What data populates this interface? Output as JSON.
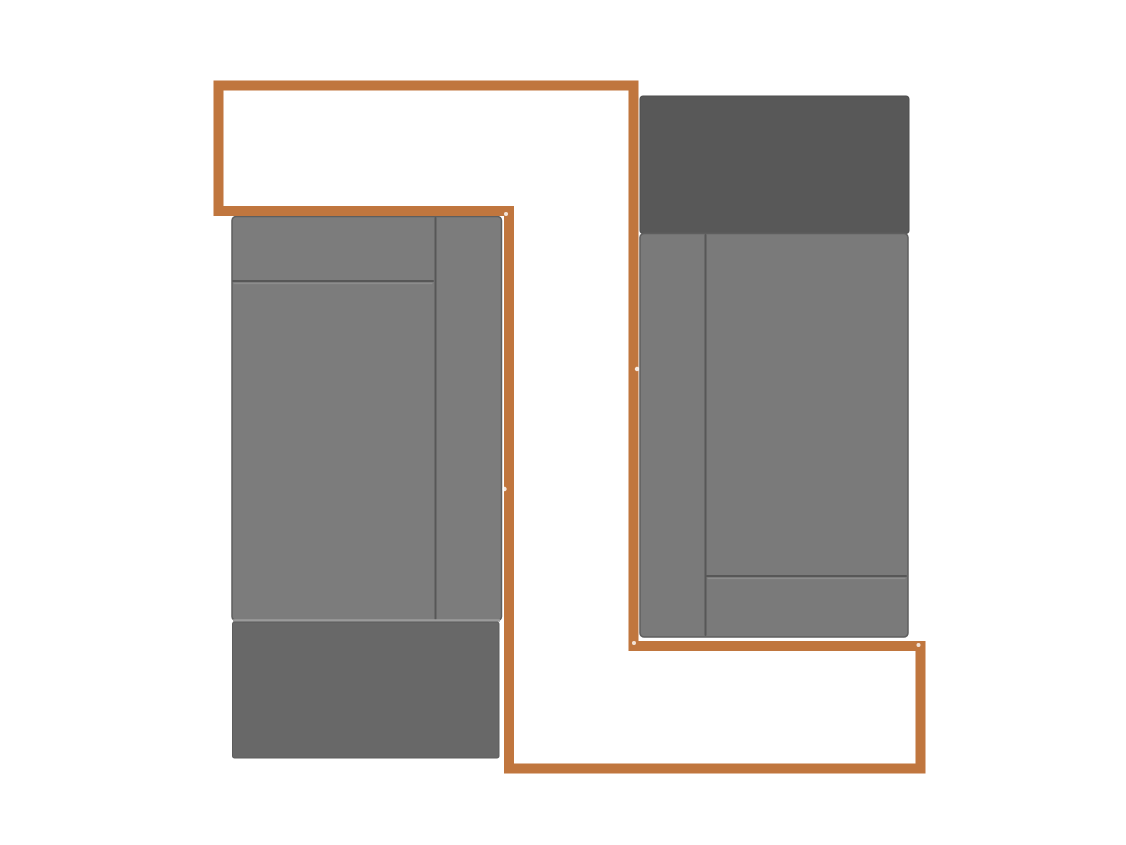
{
  "app": {
    "view_label": "cabinet-layout-design-view"
  },
  "canvas": {
    "width": 1126,
    "height": 845,
    "background": "#ffffff"
  },
  "palette": {
    "outline_orange": "#c0763e",
    "left_cabinet_body": "#7c7c7c",
    "left_cabinet_base": "#686868",
    "right_cabinet_top": "#585858",
    "right_cabinet_body": "#7a7a7a",
    "panel_line": "#575757",
    "panel_highlight": "#9b9b9b",
    "edge_stroke": "#5e5e5e",
    "marker_white": "#ffffff"
  },
  "shapes": [
    {
      "name": "left-cabinet-body",
      "interactable": true,
      "type": "rect",
      "x": 232,
      "y": 216.5,
      "w": 269.5,
      "h": 404,
      "fill": "#7c7c7c",
      "stroke": "#5e5e5e",
      "stroke_width": 1.5,
      "rx": 4
    },
    {
      "name": "left-cabinet-drawer-divider-line",
      "interactable": false,
      "type": "line",
      "x1": 233,
      "y1": 281,
      "x2": 433,
      "y2": 281,
      "stroke": "#575757",
      "stroke_width": 2,
      "linecap": "round"
    },
    {
      "name": "left-cabinet-drawer-divider-highlight",
      "interactable": false,
      "type": "line",
      "x1": 234,
      "y1": 283.5,
      "x2": 432,
      "y2": 283.5,
      "stroke": "#8d8d8d",
      "stroke_width": 1.2,
      "linecap": "round"
    },
    {
      "name": "left-cabinet-stile-divider-line",
      "interactable": false,
      "type": "line",
      "x1": 435.5,
      "y1": 218,
      "x2": 435.5,
      "y2": 619,
      "stroke": "#575757",
      "stroke_width": 2,
      "linecap": "round"
    },
    {
      "name": "left-cabinet-body-bottom-highlight",
      "interactable": false,
      "type": "line",
      "x1": 233,
      "y1": 620.5,
      "x2": 500,
      "y2": 620.5,
      "stroke": "#9b9b9b",
      "stroke_width": 2.5,
      "linecap": "butt"
    },
    {
      "name": "left-cabinet-base-panel",
      "interactable": true,
      "type": "rect",
      "x": 232.5,
      "y": 622,
      "w": 266.5,
      "h": 136,
      "fill": "#686868",
      "stroke": "#5c5c5c",
      "stroke_width": 1,
      "rx": 2
    },
    {
      "name": "right-cabinet-top-panel",
      "interactable": true,
      "type": "rect",
      "x": 640,
      "y": 96,
      "w": 269,
      "h": 137.5,
      "fill": "#585858",
      "stroke": "#4e4e4e",
      "stroke_width": 1,
      "rx": 3
    },
    {
      "name": "right-cabinet-body",
      "interactable": true,
      "type": "rect",
      "x": 640,
      "y": 233.5,
      "w": 268,
      "h": 403.5,
      "fill": "#7a7a7a",
      "stroke": "#5e5e5e",
      "stroke_width": 1.5,
      "rx": 4
    },
    {
      "name": "right-cabinet-stile-divider-line",
      "interactable": false,
      "type": "line",
      "x1": 705.5,
      "y1": 235,
      "x2": 705.5,
      "y2": 635,
      "stroke": "#575757",
      "stroke_width": 2,
      "linecap": "round"
    },
    {
      "name": "right-cabinet-drawer-divider-line",
      "interactable": false,
      "type": "line",
      "x1": 707,
      "y1": 576,
      "x2": 906,
      "y2": 576,
      "stroke": "#575757",
      "stroke_width": 2,
      "linecap": "round"
    },
    {
      "name": "right-cabinet-drawer-divider-highlight",
      "interactable": false,
      "type": "line",
      "x1": 708,
      "y1": 578.5,
      "x2": 905,
      "y2": 578.5,
      "stroke": "#8d8d8d",
      "stroke_width": 1.2,
      "linecap": "round"
    },
    {
      "name": "wall-outline-path",
      "interactable": true,
      "type": "polygon",
      "points": [
        [
          218.5,
          85.5
        ],
        [
          633.5,
          85.5
        ],
        [
          633.5,
          646
        ],
        [
          920.5,
          646
        ],
        [
          920.5,
          768.5
        ],
        [
          509,
          768.5
        ],
        [
          509,
          211
        ],
        [
          218.5,
          211
        ]
      ],
      "fill": "none",
      "stroke": "#c0763e",
      "stroke_width": 10,
      "linejoin": "miter"
    },
    {
      "name": "path-snap-marker",
      "interactable": true,
      "type": "circle",
      "cx": 637,
      "cy": 369,
      "r": 2.2,
      "fill": "#ffffff",
      "opacity": 0.85
    },
    {
      "name": "path-snap-marker",
      "interactable": true,
      "type": "circle",
      "cx": 504.5,
      "cy": 489,
      "r": 2.2,
      "fill": "#ffffff",
      "opacity": 0.85
    },
    {
      "name": "path-snap-marker",
      "interactable": true,
      "type": "circle",
      "cx": 634,
      "cy": 643,
      "r": 2,
      "fill": "#ffffff",
      "opacity": 0.8
    },
    {
      "name": "path-snap-marker",
      "interactable": true,
      "type": "circle",
      "cx": 918.5,
      "cy": 645,
      "r": 2,
      "fill": "#ffffff",
      "opacity": 0.8
    },
    {
      "name": "path-snap-marker",
      "interactable": true,
      "type": "circle",
      "cx": 506,
      "cy": 214,
      "r": 2,
      "fill": "#ffffff",
      "opacity": 0.8
    }
  ]
}
